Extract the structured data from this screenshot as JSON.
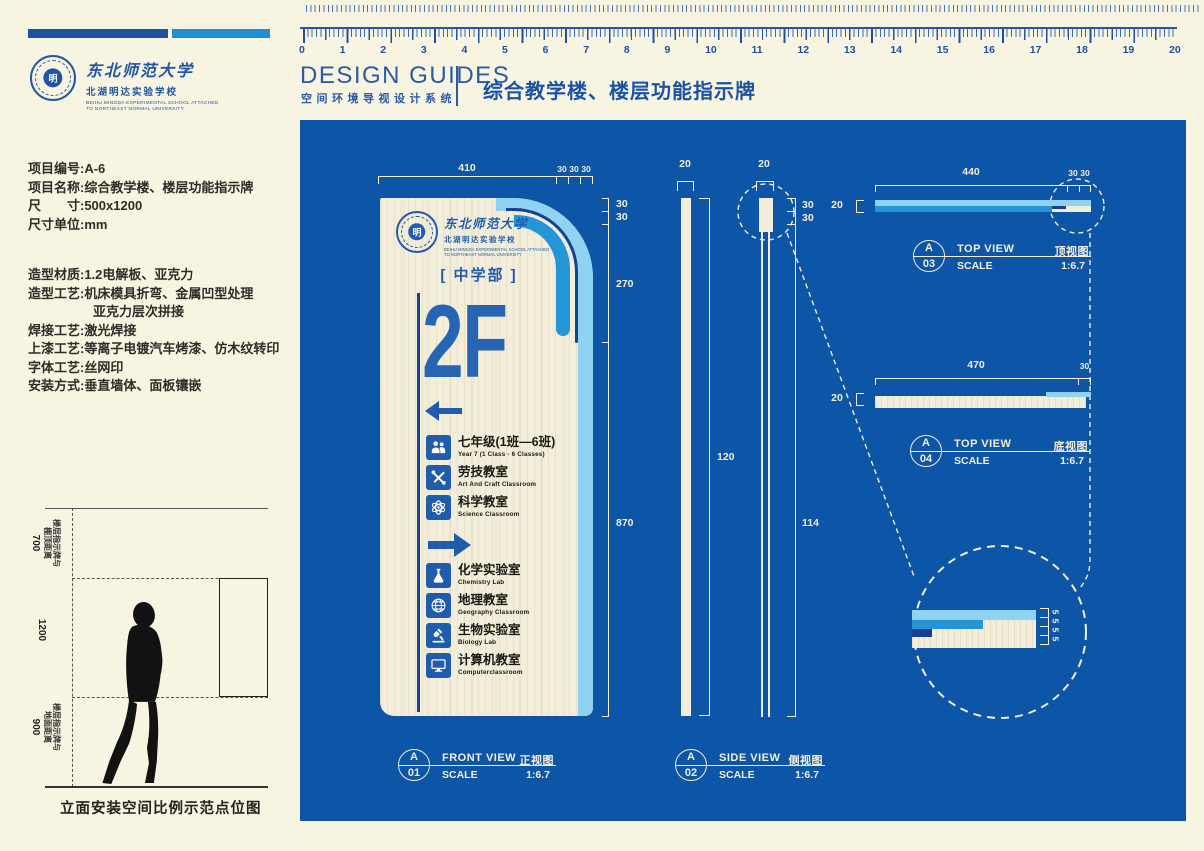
{
  "brand": {
    "university": "东北师范大学",
    "school": "北湖明达实验学校",
    "school_en1": "BEIHU MINGDA EXPERIMENTAL SCHOOL ATTACHED",
    "school_en2": "TO NORTHEAST NORMAL UNIVERSITY",
    "emblem_char": "明"
  },
  "header": {
    "title_en": "DESIGN GUIDES",
    "subtitle_cn": "空间环境导视设计系统",
    "project_title": "综合教学楼、楼层功能指示牌"
  },
  "ruler": {
    "numbers": [
      "0",
      "1",
      "2",
      "3",
      "4",
      "5",
      "6",
      "7",
      "8",
      "9",
      "10",
      "11",
      "12",
      "13",
      "14",
      "15",
      "16",
      "17",
      "18",
      "19",
      "20"
    ]
  },
  "info": {
    "groups": [
      [
        "项目编号:A-6",
        "项目名称:综合教学楼、楼层功能指示牌",
        "尺　　寸:500x1200",
        "尺寸单位:mm"
      ],
      [
        "造型材质:1.2电解板、亚克力",
        "造型工艺:机床模具折弯、金属凹型处理",
        "　　　　　亚克力层次拼接",
        "焊接工艺:激光焊接",
        "上漆工艺:等离子电镀汽车烤漆、仿木纹转印",
        "字体工艺:丝网印",
        "安装方式:垂直墙体、面板镶嵌"
      ]
    ]
  },
  "elevation": {
    "top_label": "楼层指示牌与",
    "top_label2": "棚顶距离",
    "top_value": "700",
    "mid_value": "1200",
    "bottom_label": "楼层指示牌与",
    "bottom_label2": "地面距离",
    "bottom_value": "900",
    "caption": "立面安装空间比例示范点位图"
  },
  "sign": {
    "section_label": "[ 中学部 ]",
    "floor": "2F",
    "rooms": [
      {
        "type": "room",
        "icon": "students-icon",
        "cn": "七年级(1班—6班)",
        "en": "Year 7 (1 Class - 6 Classes)"
      },
      {
        "type": "room",
        "icon": "tools-icon",
        "cn": "劳技教室",
        "en": "Art And Craft Classroom"
      },
      {
        "type": "room",
        "icon": "atom-icon",
        "cn": "科学教室",
        "en": "Science Classroom"
      },
      {
        "type": "arrow"
      },
      {
        "type": "room",
        "icon": "flask-icon",
        "cn": "化学实验室",
        "en": "Chemistry Lab"
      },
      {
        "type": "room",
        "icon": "globe-icon",
        "cn": "地理教室",
        "en": "Geography Classroom"
      },
      {
        "type": "room",
        "icon": "microscope-icon",
        "cn": "生物实验室",
        "en": "Biology Lab"
      },
      {
        "type": "room",
        "icon": "computer-icon",
        "cn": "计算机教室",
        "en": "Computerclassroom"
      }
    ]
  },
  "views": {
    "front": {
      "code": "A",
      "num": "01",
      "en": "FRONT VIEW",
      "cn": "正视图",
      "scale_label": "SCALE",
      "scale": "1:6.7"
    },
    "side": {
      "code": "A",
      "num": "02",
      "en": "SIDE VIEW",
      "cn": "侧视图",
      "scale_label": "SCALE",
      "scale": "1:6.7"
    },
    "top": {
      "code": "A",
      "num": "03",
      "en": "TOP VIEW",
      "cn": "顶视图",
      "scale_label": "SCALE",
      "scale": "1:6.7"
    },
    "bottom": {
      "code": "A",
      "num": "04",
      "en": "TOP VIEW",
      "cn": "底视图",
      "scale_label": "SCALE",
      "scale": "1:6.7"
    }
  },
  "dims": {
    "front_top": [
      "410",
      "30",
      "30",
      "30"
    ],
    "front_right": [
      "30",
      "30",
      "270",
      "870"
    ],
    "side_bar1_w": "20",
    "side_bar2_w": "20",
    "side_r1": "30",
    "side_r2": "30",
    "side_h1": "120",
    "side_h2": "114",
    "top_w": "20",
    "top_len": "440",
    "top_r1": "30",
    "top_r2": "30",
    "bottom_w": "20",
    "bottom_len": "470",
    "bottom_r": "30",
    "detail_layers": [
      "5",
      "5",
      "5",
      "5"
    ]
  },
  "colors": {
    "panel_blue": "#0d55a6",
    "light_blue": "#8fd2f1",
    "mid_blue": "#2496d8",
    "navy": "#16418f",
    "accent_blue": "#1f5cad",
    "cream": "#f3eedb"
  }
}
